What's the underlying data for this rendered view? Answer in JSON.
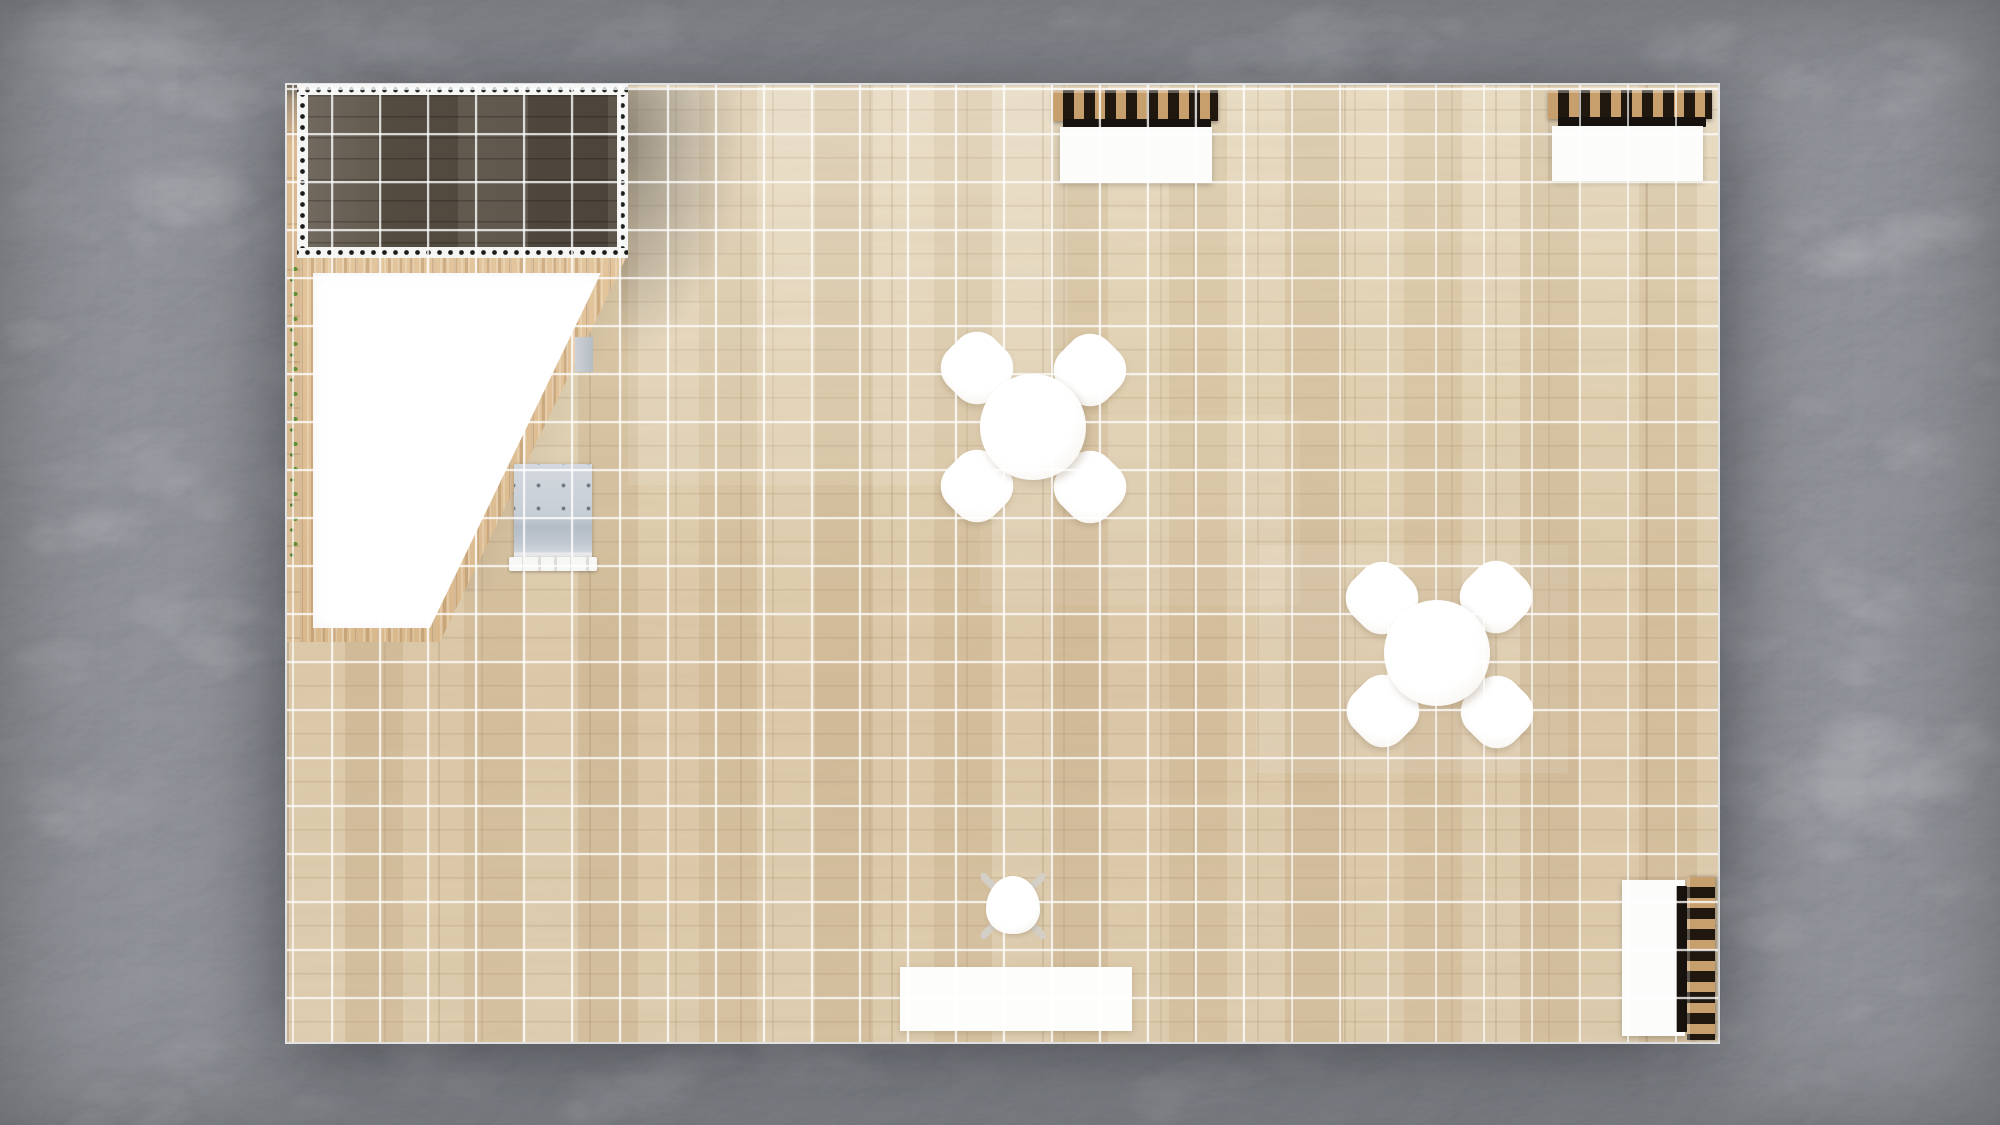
{
  "canvas": {
    "width": 2000,
    "height": 1125
  },
  "palette": {
    "marble_base": "#696c71",
    "marble_dark": "#55585e",
    "marble_vein": "#c3c6cb",
    "floor_light": "#e8dbc1",
    "floor_mid": "#d9c4a2",
    "grid_line": "rgba(255,255,255,0.78)",
    "pergola_dark": "#5d5447",
    "wood_trim": "#ddbb90",
    "white_surface": "#ffffff",
    "slat_wood": "#c79f6d",
    "slat_dark": "#20180f",
    "bench_gray": "#b4bcc6",
    "plant_green": "#5f9032",
    "dot_black": "#1b1b1b"
  },
  "scene": {
    "booth": {
      "x": 287,
      "y": 85,
      "w": 1431,
      "h": 957,
      "grid_cell": 48
    },
    "objects": [
      {
        "name": "pergola-cast-shadow",
        "type": "shadow-pergola",
        "x": 620,
        "y": 88,
        "w": 175,
        "h": 440
      },
      {
        "name": "counter-diagonal-shadow",
        "type": "shadow-diagonal",
        "x": 430,
        "y": 252,
        "w": 250,
        "h": 340,
        "clip": "polygon(79% 0%, 100% 0%, 100% 100%, 10% 100%)"
      },
      {
        "name": "floor-highlight-upper",
        "type": "glow",
        "x": 628,
        "y": 85,
        "w": 440,
        "h": 400,
        "opacity": 0.1
      },
      {
        "name": "floor-highlight-right",
        "type": "glow",
        "x": 1256,
        "y": 545,
        "w": 312,
        "h": 228,
        "opacity": 0.1
      },
      {
        "name": "floor-highlight-center",
        "type": "glow",
        "x": 980,
        "y": 415,
        "w": 320,
        "h": 190,
        "opacity": 0.07
      },
      {
        "name": "left-edge-wood-strip",
        "type": "wood-strip",
        "x": 287,
        "y": 85,
        "w": 14,
        "h": 557
      },
      {
        "name": "planter-leaf-row",
        "type": "plants",
        "x": 288,
        "y": 262,
        "w": 13,
        "h": 302
      },
      {
        "name": "pergola-dot-band-top",
        "type": "dot-band-h",
        "x": 297,
        "y": 84,
        "w": 331,
        "h": 12
      },
      {
        "name": "pergola-dot-band-bottom",
        "type": "dot-band-h",
        "x": 297,
        "y": 247,
        "w": 331,
        "h": 11
      },
      {
        "name": "pergola-dot-band-left",
        "type": "dot-band-v",
        "x": 297,
        "y": 95,
        "w": 11,
        "h": 153
      },
      {
        "name": "pergola-dot-band-right",
        "type": "dot-band-v",
        "x": 617,
        "y": 95,
        "w": 11,
        "h": 153
      },
      {
        "name": "pergola-canopy",
        "type": "canopy",
        "x": 308,
        "y": 95,
        "w": 309,
        "h": 152
      },
      {
        "name": "reception-counter-trim",
        "type": "counter-wood",
        "x": 300,
        "y": 258,
        "w": 326,
        "h": 384,
        "clip": "polygon(0% 0%, 100% 0%, 42.9% 100%, 0% 100%)"
      },
      {
        "name": "reception-counter-top",
        "type": "counter-white",
        "x": 313,
        "y": 273,
        "w": 288,
        "h": 355,
        "clip": "polygon(0% 0%, 100% 0%, 40.6% 100%, 0% 100%)"
      },
      {
        "name": "wall-side-panel",
        "type": "side-panel",
        "x": 575,
        "y": 337,
        "w": 18,
        "h": 35
      },
      {
        "name": "tufted-bench",
        "type": "bench",
        "x": 514,
        "y": 464,
        "w": 78,
        "h": 104
      },
      {
        "name": "shelf-top-left-slats",
        "type": "slats-h",
        "x": 1053,
        "y": 90,
        "w": 165,
        "h": 31
      },
      {
        "name": "shelf-top-left-shadow",
        "type": "dark-strip",
        "x": 1063,
        "y": 119,
        "w": 148,
        "h": 10
      },
      {
        "name": "shelf-top-left-cabinet",
        "type": "cabinet",
        "x": 1060,
        "y": 127,
        "w": 152,
        "h": 56
      },
      {
        "name": "shelf-top-right-slats",
        "type": "slats-h",
        "x": 1548,
        "y": 90,
        "w": 164,
        "h": 29
      },
      {
        "name": "shelf-top-right-shadow",
        "type": "dark-strip",
        "x": 1558,
        "y": 117,
        "w": 148,
        "h": 10
      },
      {
        "name": "shelf-top-right-cabinet",
        "type": "cabinet",
        "x": 1552,
        "y": 126,
        "w": 151,
        "h": 55
      },
      {
        "name": "shelf-right-cabinet",
        "type": "cabinet",
        "x": 1622,
        "y": 880,
        "w": 63,
        "h": 156
      },
      {
        "name": "shelf-right-shadow",
        "type": "dark-strip-v",
        "x": 1676,
        "y": 886,
        "w": 11,
        "h": 146
      },
      {
        "name": "shelf-right-slats",
        "type": "slats-v",
        "x": 1687,
        "y": 877,
        "w": 28,
        "h": 163
      },
      {
        "name": "dining1-chair-nw",
        "type": "chair-blob",
        "x": 944,
        "y": 335,
        "w": 66,
        "h": 66
      },
      {
        "name": "dining1-chair-ne",
        "type": "chair-blob",
        "x": 1057,
        "y": 337,
        "w": 66,
        "h": 66
      },
      {
        "name": "dining1-chair-sw",
        "type": "chair-blob",
        "x": 944,
        "y": 453,
        "w": 66,
        "h": 66
      },
      {
        "name": "dining1-chair-se",
        "type": "chair-blob",
        "x": 1057,
        "y": 454,
        "w": 66,
        "h": 66
      },
      {
        "name": "dining1-table",
        "type": "table-round",
        "x": 980,
        "y": 374,
        "w": 106,
        "h": 106
      },
      {
        "name": "dining2-chair-nw",
        "type": "chair-blob",
        "x": 1349,
        "y": 565,
        "w": 66,
        "h": 66
      },
      {
        "name": "dining2-chair-ne",
        "type": "chair-blob",
        "x": 1463,
        "y": 564,
        "w": 66,
        "h": 66
      },
      {
        "name": "dining2-chair-sw",
        "type": "chair-blob",
        "x": 1350,
        "y": 678,
        "w": 66,
        "h": 66
      },
      {
        "name": "dining2-chair-se",
        "type": "chair-blob",
        "x": 1464,
        "y": 679,
        "w": 66,
        "h": 66
      },
      {
        "name": "dining2-table",
        "type": "table-round",
        "x": 1384,
        "y": 600,
        "w": 106,
        "h": 106
      },
      {
        "name": "task-chair",
        "type": "desk-chair",
        "x": 981,
        "y": 873,
        "w": 64,
        "h": 66
      },
      {
        "name": "reception-desk",
        "type": "desk",
        "x": 900,
        "y": 967,
        "w": 232,
        "h": 64
      },
      {
        "name": "floor-grid",
        "type": "grid-overlay",
        "x": 287,
        "y": 85,
        "w": 1431,
        "h": 957
      }
    ]
  }
}
